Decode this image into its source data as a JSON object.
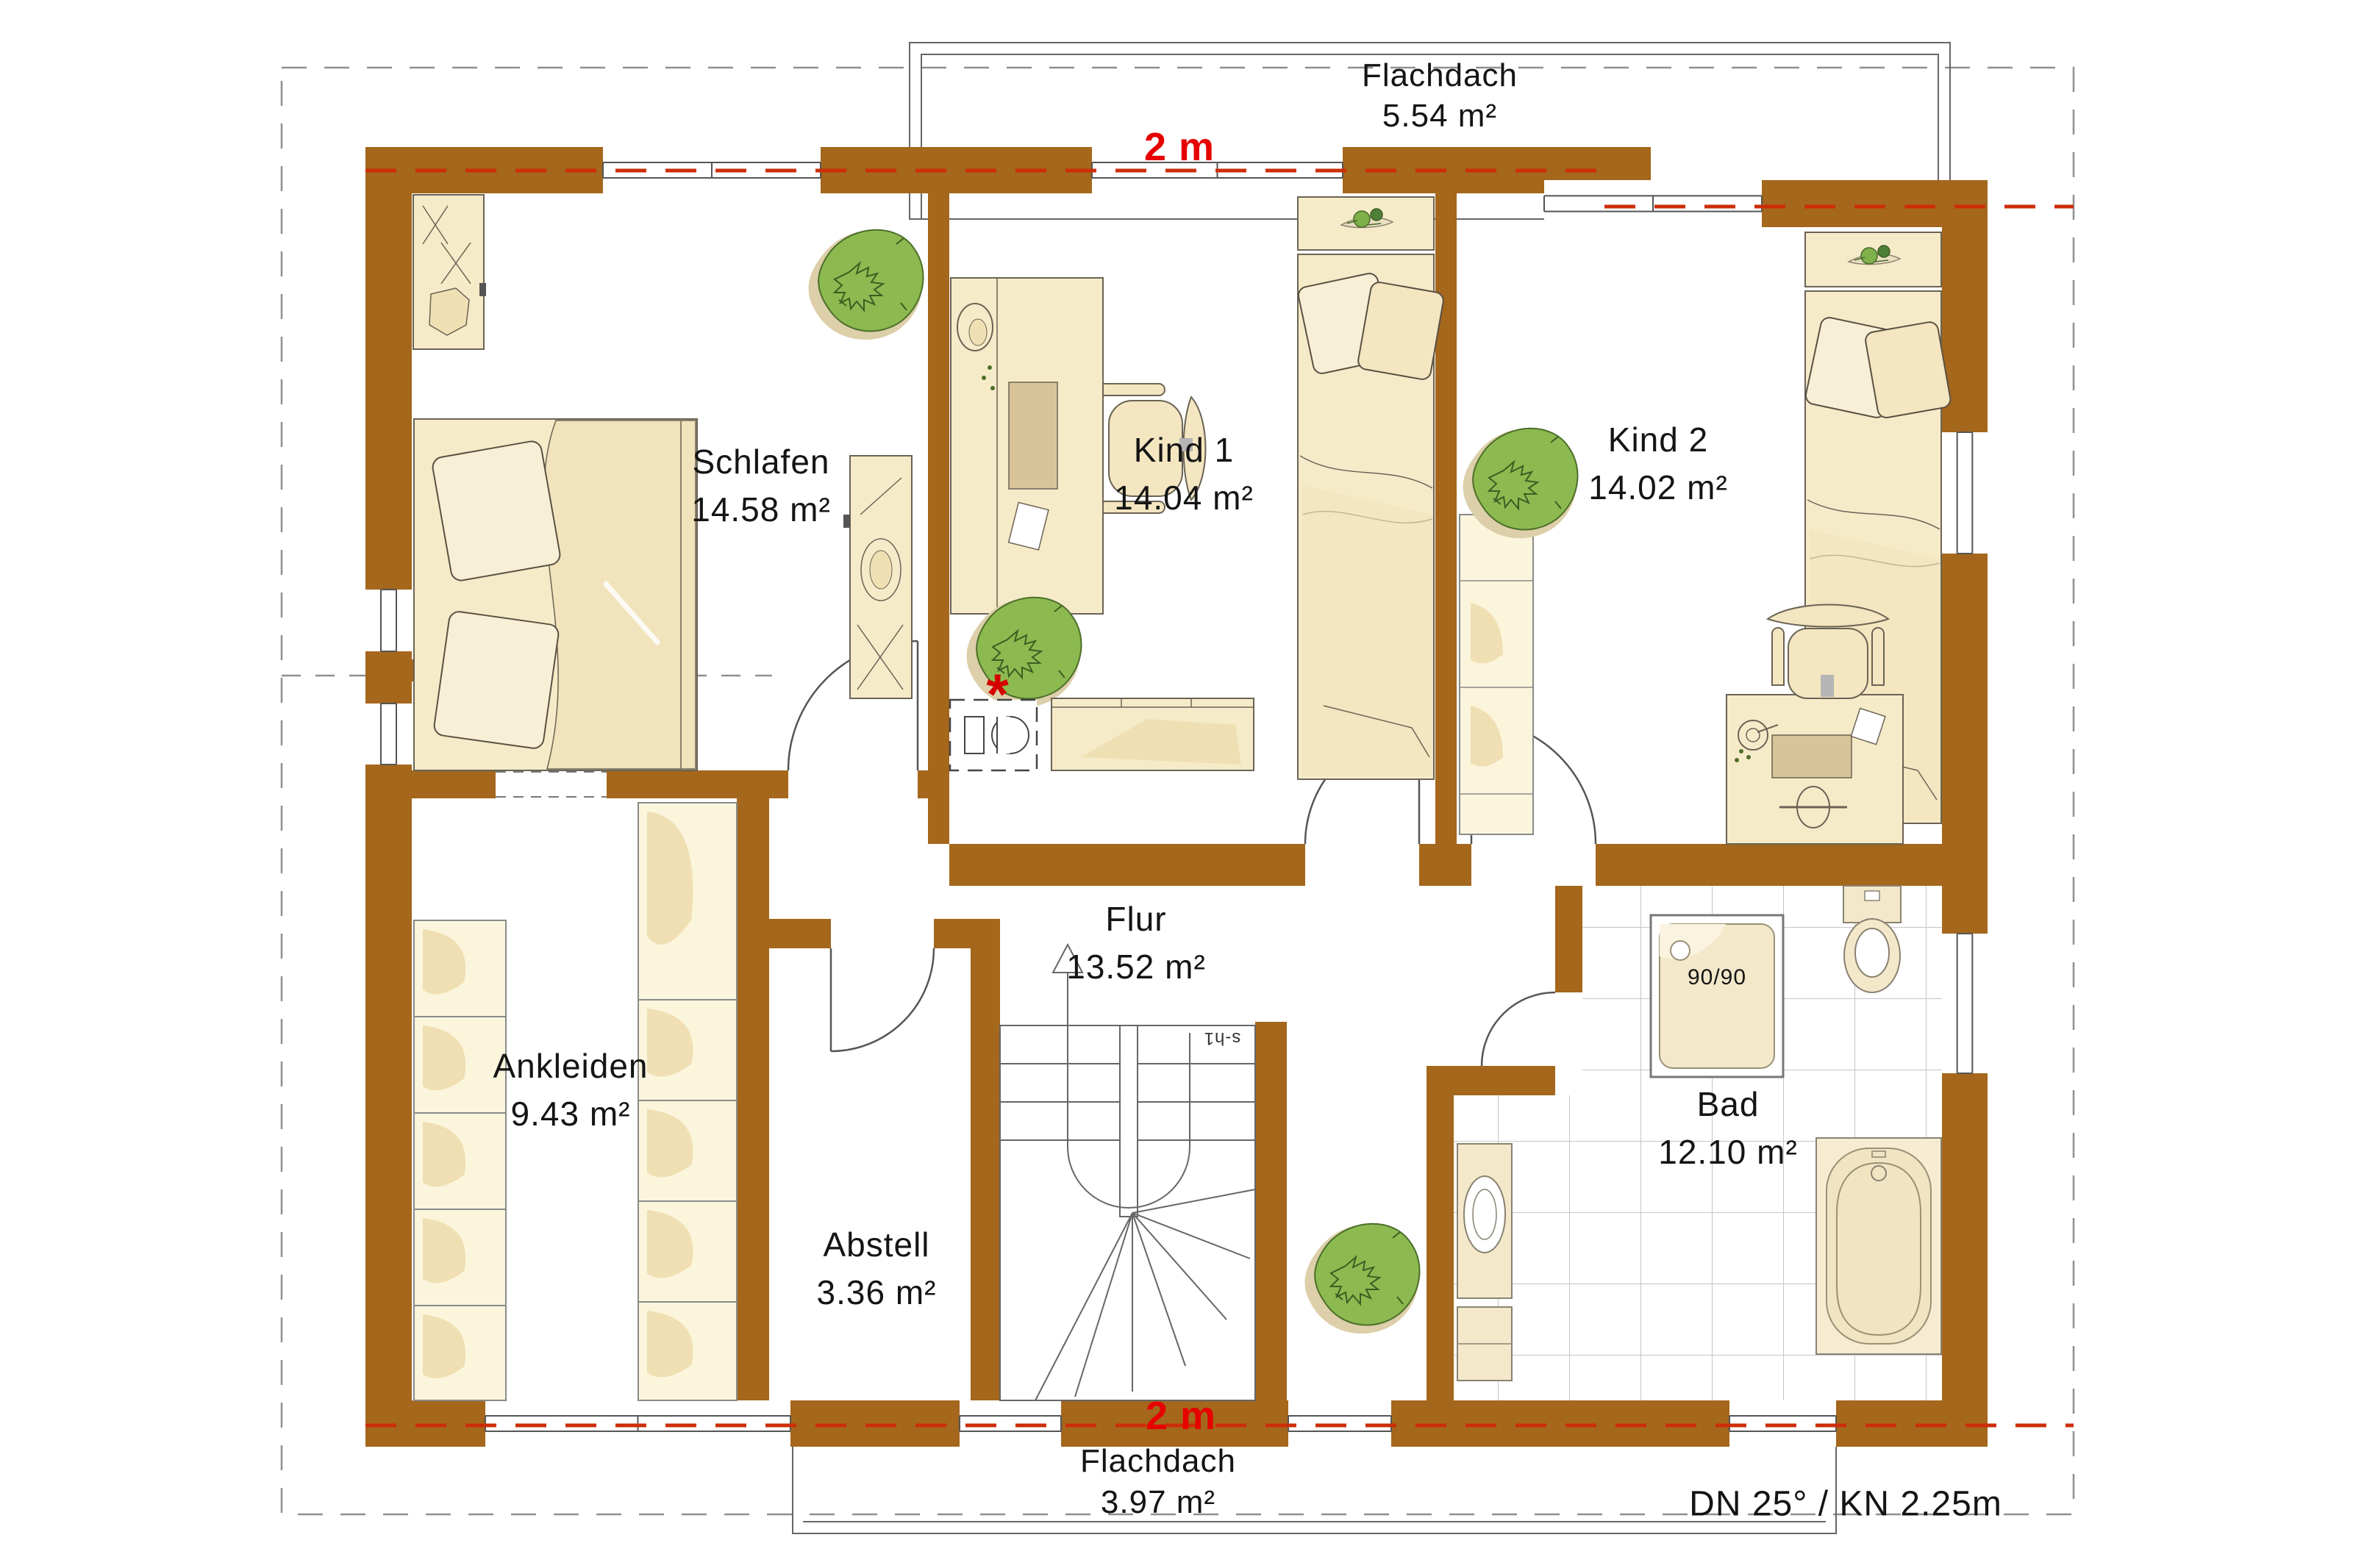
{
  "plan": {
    "rooms": [
      {
        "id": "schlafen",
        "name": "Schlafen",
        "area": "14.58 m²"
      },
      {
        "id": "kind1",
        "name": "Kind 1",
        "area": "14.04 m²"
      },
      {
        "id": "kind2",
        "name": "Kind 2",
        "area": "14.02 m²"
      },
      {
        "id": "ankleiden",
        "name": "Ankleiden",
        "area": "9.43 m²"
      },
      {
        "id": "abstell",
        "name": "Abstell",
        "area": "3.36 m²"
      },
      {
        "id": "flur",
        "name": "Flur",
        "area": "13.52 m²"
      },
      {
        "id": "bad",
        "name": "Bad",
        "area": "12.10 m²"
      }
    ],
    "roof_areas": [
      {
        "id": "flachdach_top",
        "name": "Flachdach",
        "area": "5.54 m²"
      },
      {
        "id": "flachdach_bottom",
        "name": "Flachdach",
        "area": "3.97 m²"
      }
    ],
    "annotations": {
      "height_line_top": "2 m",
      "height_line_bottom": "2 m",
      "shower_size": "90/90",
      "stair_code": "s-h1",
      "asterisk": "*",
      "roof_note": "DN 25° / KN 2.25m"
    },
    "colors": {
      "wall": "#A4671C",
      "red_line": "#CC2E08",
      "red_text": "#E60000",
      "furniture": "#F6EBC8",
      "furniture_shade": "#F1E3BB",
      "wardrobe": "#FBF5DC",
      "plant_green": "#8CBA50",
      "tile_line": "#C6C6C6"
    }
  }
}
